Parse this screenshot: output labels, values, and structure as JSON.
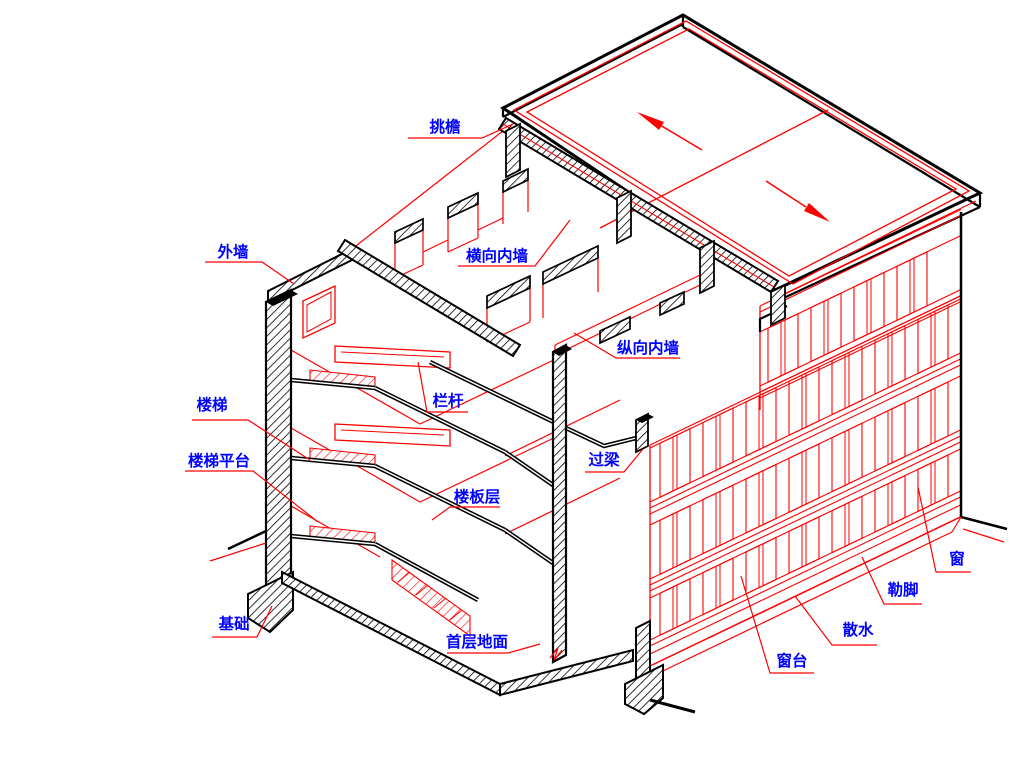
{
  "page": {
    "background": "#ffffff"
  },
  "diagram": {
    "type": "axonometric-building-section",
    "description": "轴测剖切示意图 (axonometric cutaway of a multi-storey building)",
    "colors": {
      "cut_line": "#000000",
      "projection_line": "#ff0000",
      "leader_line": "#ff0000",
      "label_text": "#0000ff",
      "background": "#ffffff"
    },
    "roof": {
      "slope_arrow_count": 2
    },
    "labels": [
      {
        "id": "tiaoyan",
        "text": "挑檐",
        "cx": 445,
        "cy": 127,
        "leader": [
          [
            408,
            138
          ],
          [
            482,
            138
          ],
          [
            513,
            124
          ]
        ]
      },
      {
        "id": "waiqiang",
        "text": "外墙",
        "cx": 233,
        "cy": 252,
        "leader": [
          [
            205,
            262
          ],
          [
            262,
            262
          ],
          [
            294,
            284
          ]
        ]
      },
      {
        "id": "hengxiang-neiqiang",
        "text": "横向内墙",
        "cx": 497,
        "cy": 256,
        "leader": [
          [
            458,
            266
          ],
          [
            535,
            266
          ],
          [
            570,
            220
          ]
        ]
      },
      {
        "id": "zongxiang-neiqiang",
        "text": "纵向内墙",
        "cx": 648,
        "cy": 348,
        "leader": [
          [
            680,
            358
          ],
          [
            616,
            358
          ],
          [
            574,
            333
          ]
        ]
      },
      {
        "id": "langan",
        "text": "栏杆",
        "cx": 448,
        "cy": 401,
        "leader": [
          [
            468,
            412
          ],
          [
            427,
            412
          ],
          [
            418,
            362
          ]
        ]
      },
      {
        "id": "louti",
        "text": "楼梯",
        "cx": 212,
        "cy": 405,
        "leader": [
          [
            192,
            420
          ],
          [
            248,
            420
          ],
          [
            310,
            460
          ]
        ]
      },
      {
        "id": "louti-pingtai",
        "text": "楼梯平台",
        "cx": 219,
        "cy": 461,
        "leader": [
          [
            185,
            471
          ],
          [
            253,
            471
          ],
          [
            318,
            522
          ]
        ]
      },
      {
        "id": "louban-ceng",
        "text": "楼板层",
        "cx": 477,
        "cy": 497,
        "leader": [
          [
            500,
            507
          ],
          [
            450,
            507
          ],
          [
            432,
            520
          ]
        ]
      },
      {
        "id": "guoliang",
        "text": "过梁",
        "cx": 604,
        "cy": 460,
        "leader": [
          [
            585,
            472
          ],
          [
            624,
            472
          ],
          [
            643,
            449
          ]
        ]
      },
      {
        "id": "jichu",
        "text": "基础",
        "cx": 234,
        "cy": 624,
        "leader": [
          [
            212,
            637
          ],
          [
            257,
            637
          ],
          [
            272,
            606
          ]
        ]
      },
      {
        "id": "shouceng-dimian",
        "text": "首层地面",
        "cx": 477,
        "cy": 642,
        "leader": [
          [
            447,
            653
          ],
          [
            508,
            653
          ],
          [
            540,
            644
          ]
        ]
      },
      {
        "id": "chuangtai",
        "text": "窗台",
        "cx": 792,
        "cy": 661,
        "leader": [
          [
            814,
            673
          ],
          [
            770,
            673
          ],
          [
            741,
            576
          ]
        ]
      },
      {
        "id": "sanshui",
        "text": "散水",
        "cx": 858,
        "cy": 630,
        "leader": [
          [
            877,
            645
          ],
          [
            832,
            645
          ],
          [
            795,
            596
          ]
        ]
      },
      {
        "id": "lejiao",
        "text": "勒脚",
        "cx": 903,
        "cy": 590,
        "leader": [
          [
            922,
            604
          ],
          [
            884,
            604
          ],
          [
            862,
            557
          ]
        ]
      },
      {
        "id": "chuang",
        "text": "窗",
        "cx": 957,
        "cy": 559,
        "leader": [
          [
            971,
            572
          ],
          [
            936,
            572
          ],
          [
            918,
            487
          ]
        ]
      }
    ]
  }
}
